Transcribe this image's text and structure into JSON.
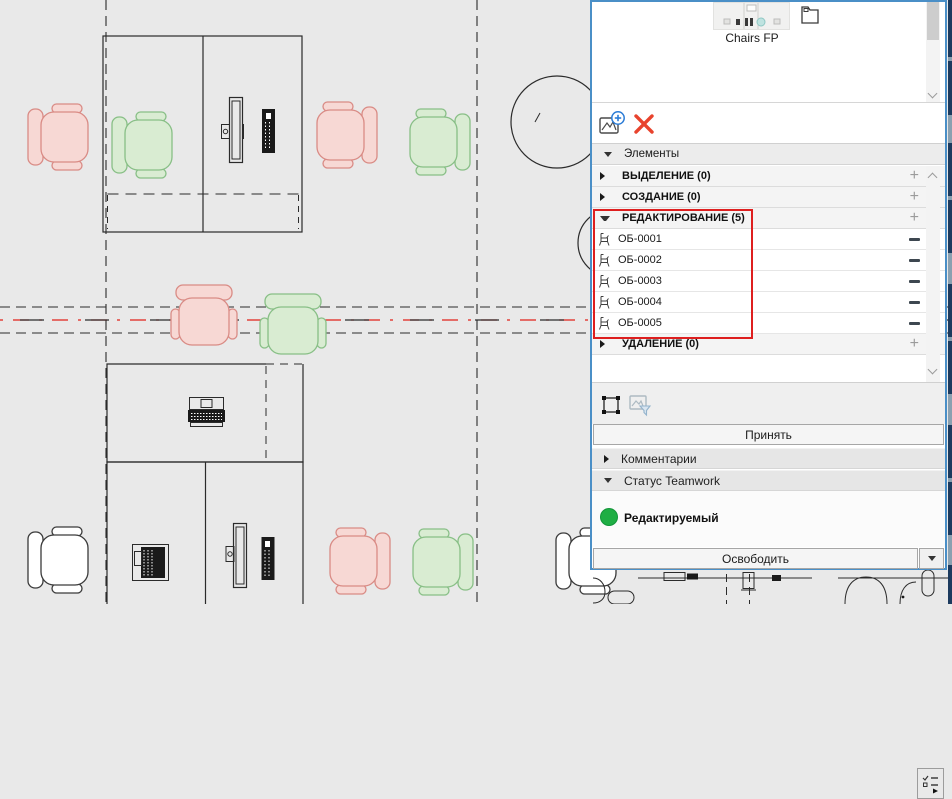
{
  "panel": {
    "library": {
      "selected_item_label": "Chairs FP"
    },
    "elements_header": "Элементы",
    "groups": [
      {
        "label": "ВЫДЕЛЕНИЕ (0)",
        "expanded": false,
        "action_glyph": "+"
      },
      {
        "label": "СОЗДАНИЕ (0)",
        "expanded": false,
        "action_glyph": "+"
      },
      {
        "label": "РЕДАКТИРОВАНИЕ (5)",
        "expanded": true,
        "action_glyph": "+",
        "items": [
          "ОБ-0001",
          "ОБ-0002",
          "ОБ-0003",
          "ОБ-0004",
          "ОБ-0005"
        ]
      },
      {
        "label": "УДАЛЕНИЕ (0)",
        "expanded": false,
        "action_glyph": "+"
      }
    ],
    "item_action_glyph": "—",
    "accept_button": "Принять",
    "comments_section": "Комментарии",
    "teamwork_status_section": "Статус Teamwork",
    "status_value": "Редактируемый",
    "release_button": "Освободить"
  },
  "icons": {
    "add_element": "picture-with-plus",
    "delete_element": "red-x",
    "marquee": "selection-marquee",
    "image_filter": "picture-funnel",
    "options": "checklist-with-arrow",
    "library_part": "folder-outline",
    "scroll_up": "chevron-up",
    "scroll_down": "chevron-down"
  },
  "colors": {
    "panel_border": "#4a8fc7",
    "annotation_red": "#de1f1f",
    "status_green": "#1fae44",
    "delete_x_red": "#e8432d",
    "add_plus_blue": "#2b7cd6",
    "chair_pink_fill": "#f7d8d4",
    "chair_pink_stroke": "#d98b85",
    "chair_green_fill": "#d9ecd2",
    "chair_green_stroke": "#88bf86",
    "canvas_bg": "#e9e9e9"
  }
}
